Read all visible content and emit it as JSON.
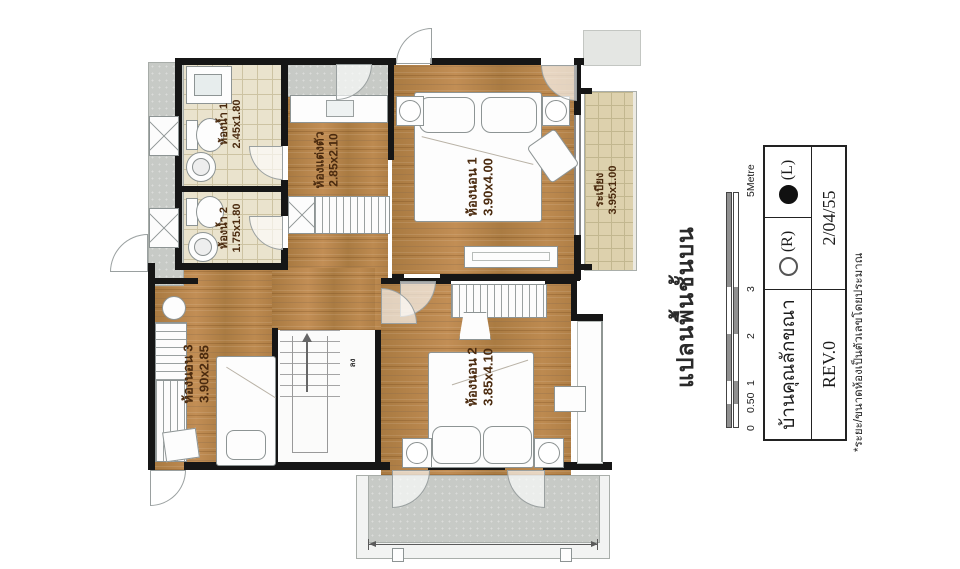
{
  "plan": {
    "rooms": [
      {
        "id": "bathroom-1",
        "name": "ห้องน้ำ 1",
        "dims": "2.45x1.80"
      },
      {
        "id": "bathroom-2",
        "name": "ห้องน้ำ 2",
        "dims": "1.75x1.80"
      },
      {
        "id": "dressing-room",
        "name": "ห้องแต่งตัว",
        "dims": "2.85x2.10"
      },
      {
        "id": "bedroom-1",
        "name": "ห้องนอน 1",
        "dims": "3.90x4.00"
      },
      {
        "id": "balcony",
        "name": "ระเบียง",
        "dims": "3.95x1.00"
      },
      {
        "id": "bedroom-3",
        "name": "ห้องนอน 3",
        "dims": "3.90x2.85"
      },
      {
        "id": "bedroom-2",
        "name": "ห้องนอน 2",
        "dims": "3.85x4.10"
      }
    ],
    "stair_label": "ลง"
  },
  "annotation": {
    "title": "แปลนพื้นชั้นบน",
    "scale": {
      "ticks": [
        "0",
        "0.50",
        "1",
        "2",
        "3",
        "5Metre"
      ]
    },
    "titleblock": {
      "project": "บ้านคุณลักขณา",
      "rev": "REV.0",
      "date": "2/04/55",
      "right_label": "(R)",
      "left_label": "(L)"
    },
    "note": "*ระยะ/ขนาดห้องเป็นตัวเลขโดยประมาณ"
  },
  "colors": {
    "wood": "#b5824a",
    "tile": "#eae3cd",
    "balcony_tile": "#ddd1ad",
    "concrete": "#c7cac6",
    "wall": "#161616",
    "label_text": "#4a2a0e"
  }
}
